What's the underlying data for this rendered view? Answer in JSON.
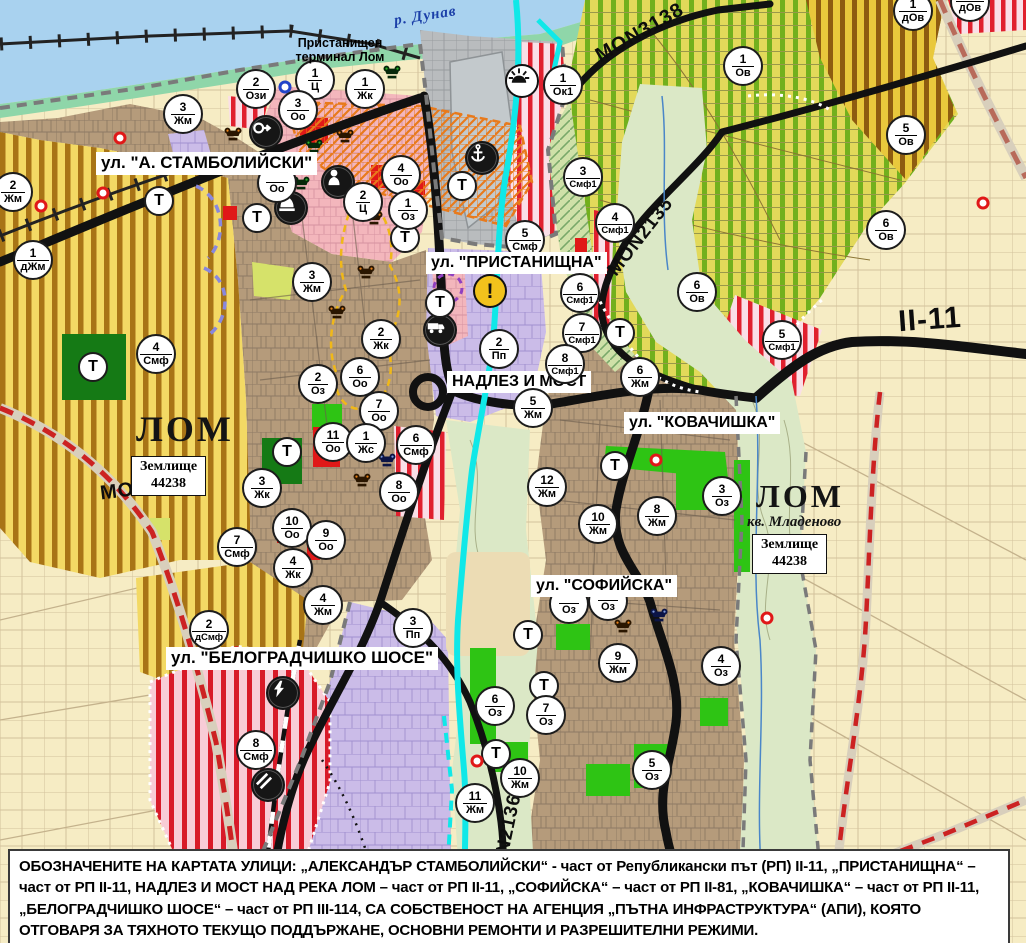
{
  "map": {
    "labels": {
      "river": "р. Дунав",
      "port_terminal": "Пристанищен терминал Лом",
      "city_west": "ЛОМ",
      "city_east": "ЛОМ",
      "district_east": "кв. Младеново",
      "land_plot_west_line1": "Землище",
      "land_plot_west_line2": "44238",
      "land_plot_east_line1": "Землище",
      "land_plot_east_line2": "44238"
    },
    "street_labels": [
      {
        "text": "ул. \"А. СТАМБОЛИЙСКИ\"",
        "x": 96,
        "y": 152,
        "fs": 17
      },
      {
        "text": "ул. \"ПРИСТАНИЩНА\"",
        "x": 426,
        "y": 252,
        "fs": 16
      },
      {
        "text": "НАДЛЕЗ И МОСТ",
        "x": 447,
        "y": 371,
        "fs": 16
      },
      {
        "text": "ул. \"КОВАЧИШКА\"",
        "x": 624,
        "y": 412,
        "fs": 16
      },
      {
        "text": "ул. \"СОФИЙСКА\"",
        "x": 531,
        "y": 575,
        "fs": 16
      },
      {
        "text": "ул. \"БЕЛОГРАДЧИШКО ШОСЕ\"",
        "x": 166,
        "y": 647,
        "fs": 17
      }
    ],
    "road_labels": [
      {
        "text": "MON3138",
        "x": 640,
        "y": 33,
        "rotate": -30,
        "fs": 20
      },
      {
        "text": "MON2135",
        "x": 641,
        "y": 237,
        "rotate": -52,
        "fs": 19
      },
      {
        "text": "II-11",
        "x": 930,
        "y": 320,
        "rotate": -4,
        "fs": 30
      },
      {
        "text": "MON3139",
        "x": 149,
        "y": 488,
        "rotate": -7,
        "fs": 20
      },
      {
        "text": "MON2136",
        "x": 506,
        "y": 840,
        "rotate": -78,
        "fs": 19
      }
    ],
    "zone_markers": [
      {
        "num": "2",
        "code": "Ози",
        "x": 256,
        "y": 89
      },
      {
        "num": "1",
        "code": "Ц",
        "x": 315,
        "y": 80
      },
      {
        "num": "1",
        "code": "Жк",
        "x": 365,
        "y": 89
      },
      {
        "num": "3",
        "code": "Оо",
        "x": 298,
        "y": 110
      },
      {
        "num": "1",
        "code": "Ок1",
        "x": 563,
        "y": 85
      },
      {
        "num": "1",
        "code": "дОв",
        "x": 913,
        "y": 11
      },
      {
        "num": "",
        "code": "дОв",
        "x": 970,
        "y": 2
      },
      {
        "num": "1",
        "code": "Ов",
        "x": 743,
        "y": 66
      },
      {
        "num": "5",
        "code": "Ов",
        "x": 906,
        "y": 135
      },
      {
        "num": "3",
        "code": "Жм",
        "x": 183,
        "y": 114
      },
      {
        "num": "2",
        "code": "Жм",
        "x": 13,
        "y": 192
      },
      {
        "num": "1",
        "code": "дЖм",
        "x": 33,
        "y": 260
      },
      {
        "num": "4",
        "code": "Оо",
        "x": 401,
        "y": 175
      },
      {
        "num": "2",
        "code": "Ц",
        "x": 363,
        "y": 202
      },
      {
        "num": "1",
        "code": "Оз",
        "x": 408,
        "y": 210
      },
      {
        "num": "",
        "code": "Оо",
        "x": 277,
        "y": 183,
        "under": true
      },
      {
        "num": "3",
        "code": "Жм",
        "x": 312,
        "y": 282
      },
      {
        "num": "2",
        "code": "Жк",
        "x": 381,
        "y": 339
      },
      {
        "num": "2",
        "code": "Оз",
        "x": 318,
        "y": 384
      },
      {
        "num": "6",
        "code": "Оо",
        "x": 360,
        "y": 377
      },
      {
        "num": "7",
        "code": "Оо",
        "x": 379,
        "y": 411
      },
      {
        "num": "11",
        "code": "Оо",
        "x": 333,
        "y": 442
      },
      {
        "num": "1",
        "code": "Жс",
        "x": 366,
        "y": 443
      },
      {
        "num": "6",
        "code": "Смф",
        "x": 416,
        "y": 445
      },
      {
        "num": "8",
        "code": "Оо",
        "x": 399,
        "y": 492
      },
      {
        "num": "10",
        "code": "Оо",
        "x": 292,
        "y": 528
      },
      {
        "num": "9",
        "code": "Оо",
        "x": 326,
        "y": 540
      },
      {
        "num": "4",
        "code": "Жк",
        "x": 293,
        "y": 568
      },
      {
        "num": "7",
        "code": "Смф",
        "x": 237,
        "y": 547
      },
      {
        "num": "3",
        "code": "Жк",
        "x": 262,
        "y": 488
      },
      {
        "num": "4",
        "code": "Смф",
        "x": 156,
        "y": 354
      },
      {
        "num": "5",
        "code": "Смф",
        "x": 525,
        "y": 240,
        "under": true
      },
      {
        "num": "3",
        "code": "Смф1",
        "x": 583,
        "y": 177
      },
      {
        "num": "4",
        "code": "Смф1",
        "x": 615,
        "y": 223
      },
      {
        "num": "6",
        "code": "Смф1",
        "x": 580,
        "y": 293
      },
      {
        "num": "7",
        "code": "Смф1",
        "x": 582,
        "y": 333
      },
      {
        "num": "2",
        "code": "Пп",
        "x": 499,
        "y": 349
      },
      {
        "num": "8",
        "code": "Смф1",
        "x": 565,
        "y": 364
      },
      {
        "num": "5",
        "code": "Смф1",
        "x": 782,
        "y": 340
      },
      {
        "num": "6",
        "code": "Ов",
        "x": 886,
        "y": 230
      },
      {
        "num": "6",
        "code": "Ов",
        "x": 697,
        "y": 292
      },
      {
        "num": "6",
        "code": "Жм",
        "x": 640,
        "y": 377
      },
      {
        "num": "5",
        "code": "Жм",
        "x": 533,
        "y": 408
      },
      {
        "num": "12",
        "code": "Жм",
        "x": 547,
        "y": 487
      },
      {
        "num": "10",
        "code": "Жм",
        "x": 598,
        "y": 524
      },
      {
        "num": "8",
        "code": "Жм",
        "x": 657,
        "y": 516
      },
      {
        "num": "3",
        "code": "Оз",
        "x": 722,
        "y": 496
      },
      {
        "num": "9",
        "code": "Жм",
        "x": 618,
        "y": 663
      },
      {
        "num": "4",
        "code": "Оз",
        "x": 721,
        "y": 666
      },
      {
        "num": "6",
        "code": "Оз",
        "x": 495,
        "y": 706
      },
      {
        "num": "7",
        "code": "Оз",
        "x": 546,
        "y": 715
      },
      {
        "num": "10",
        "code": "Жм",
        "x": 520,
        "y": 778
      },
      {
        "num": "11",
        "code": "Жм",
        "x": 475,
        "y": 803
      },
      {
        "num": "5",
        "code": "Оз",
        "x": 652,
        "y": 770
      },
      {
        "num": "2",
        "code": "дСмф",
        "x": 209,
        "y": 630
      },
      {
        "num": "4",
        "code": "Жм",
        "x": 323,
        "y": 605
      },
      {
        "num": "3",
        "code": "Пп",
        "x": 413,
        "y": 628
      },
      {
        "num": "8",
        "code": "Смф",
        "x": 256,
        "y": 750
      },
      {
        "num": "",
        "code": "Оз",
        "x": 569,
        "y": 604,
        "under": true
      },
      {
        "num": "",
        "code": "Оз",
        "x": 608,
        "y": 601,
        "under": true
      }
    ],
    "transport_markers": [
      {
        "x": 159,
        "y": 201
      },
      {
        "x": 257,
        "y": 218
      },
      {
        "x": 405,
        "y": 238
      },
      {
        "x": 462,
        "y": 186
      },
      {
        "x": 440,
        "y": 303
      },
      {
        "x": 287,
        "y": 452
      },
      {
        "x": 93,
        "y": 367
      },
      {
        "x": 620,
        "y": 333
      },
      {
        "x": 615,
        "y": 466
      },
      {
        "x": 528,
        "y": 635
      },
      {
        "x": 544,
        "y": 686
      },
      {
        "x": 496,
        "y": 754
      }
    ],
    "poi_markers": [
      {
        "kind": "cultural-monument-orange",
        "x": 239,
        "y": 141
      },
      {
        "kind": "cultural-monument-orange",
        "x": 351,
        "y": 143
      },
      {
        "kind": "cultural-monument-orange",
        "x": 380,
        "y": 225
      },
      {
        "kind": "cultural-monument-orange",
        "x": 372,
        "y": 279
      },
      {
        "kind": "cultural-monument-orange",
        "x": 343,
        "y": 319
      },
      {
        "kind": "cultural-monument-orange",
        "x": 368,
        "y": 487
      },
      {
        "kind": "cultural-monument-orange",
        "x": 629,
        "y": 633
      },
      {
        "kind": "cultural-monument-green",
        "x": 398,
        "y": 79
      },
      {
        "kind": "cultural-monument-green",
        "x": 320,
        "y": 153
      },
      {
        "kind": "cultural-monument-green",
        "x": 307,
        "y": 190
      },
      {
        "kind": "cultural-monument-blue",
        "x": 393,
        "y": 467
      },
      {
        "kind": "cultural-monument-blue",
        "x": 665,
        "y": 622
      },
      {
        "kind": "key",
        "x": 266,
        "y": 132
      },
      {
        "kind": "person",
        "x": 338,
        "y": 182
      },
      {
        "kind": "dome",
        "x": 291,
        "y": 208
      },
      {
        "kind": "anchor",
        "x": 482,
        "y": 158
      },
      {
        "kind": "sun",
        "x": 522,
        "y": 81
      },
      {
        "kind": "truck",
        "x": 440,
        "y": 330
      },
      {
        "kind": "lightning",
        "x": 283,
        "y": 693
      },
      {
        "kind": "rail-crossing",
        "x": 268,
        "y": 785
      },
      {
        "kind": "warning",
        "x": 490,
        "y": 291
      }
    ],
    "dot_markers": [
      {
        "color": "red",
        "x": 120,
        "y": 138
      },
      {
        "color": "red",
        "x": 103,
        "y": 193
      },
      {
        "color": "red",
        "x": 41,
        "y": 206
      },
      {
        "color": "red",
        "x": 656,
        "y": 460
      },
      {
        "color": "red",
        "x": 477,
        "y": 761
      },
      {
        "color": "red",
        "x": 767,
        "y": 618
      },
      {
        "color": "red",
        "x": 983,
        "y": 203
      },
      {
        "color": "blue",
        "x": 285,
        "y": 87
      }
    ],
    "colors": {
      "water": "#a9d2ef",
      "shore": "#8fd6a9",
      "urban": "#b59b7b",
      "lavender": "#cbbce8",
      "pink_center": "#f3b6bc",
      "vineyard_green": "#72b01d",
      "red_stripe": "#e0202e",
      "road_black": "#111111",
      "road_red_dash": "#cc2222",
      "cyan_water": "#10e8e8"
    }
  },
  "footer": {
    "text": "ОБОЗНАЧЕНИТЕ НА КАРТАТА УЛИЦИ: „АЛЕКСАНДЪР СТАМБОЛИЙСКИ“ - част от Републикански път (РП) II-11, „ПРИСТАНИЩНА“ – част от РП II-11, НАДЛЕЗ И МОСТ НАД РЕКА ЛОМ – част от РП II-11, „СОФИЙСКА“ – част от РП II-81, „КОВАЧИШКА“ – част от РП II-11, „БЕЛОГРАДЧИШКО ШОСЕ“ – част от РП III-114, СА СОБСТВЕНОСТ НА АГЕНЦИЯ „ПЪТНА ИНФРАСТРУКТУРА“ (АПИ), КОЯТО ОТГОВАРЯ ЗА ТЯХНОТО ТЕКУЩО ПОДДЪРЖАНЕ, ОСНОВНИ РЕМОНТИ И РАЗРЕШИТЕЛНИ РЕЖИМИ."
  }
}
